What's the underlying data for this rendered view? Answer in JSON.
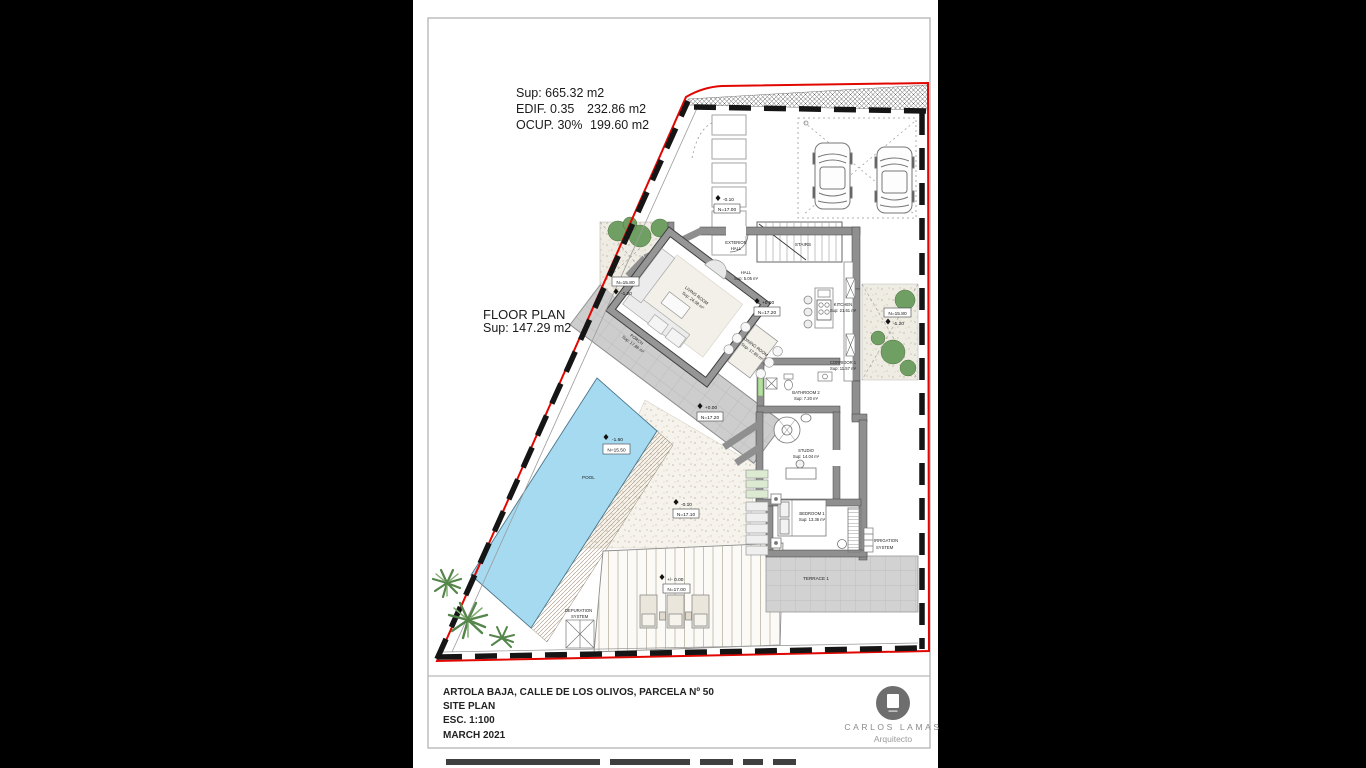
{
  "stats": {
    "line1": "Sup: 665.32 m2",
    "edif_label": "EDIF. 0.35",
    "edif_value": "232.86 m2",
    "ocup_label": "OCUP. 30%",
    "ocup_value": "199.60 m2"
  },
  "floor_plan": {
    "title": "FLOOR PLAN",
    "area": "Sup: 147.29 m2"
  },
  "rooms": {
    "exterior_hall_1": "EXTERIOR",
    "exterior_hall_2": "HALL",
    "hall_name": "HALL",
    "hall_area": "Sup: 5.05 m²",
    "living_name": "LIVING ROOM",
    "living_area": "Sup: 24.58 m²",
    "dining_name": "DINING ROOM",
    "dining_area": "Sup: 17.80 m²",
    "kitchen_name": "KITCHEN",
    "kitchen_area": "Sup: 21.61 m²",
    "corridor_name": "CORRIDOR 1",
    "corridor_area": "Sup: 11.57 m²",
    "bathroom2_name": "BATHROOM 2",
    "bathroom2_area": "Sup: 7.20 m²",
    "studio_name": "STUDIO",
    "studio_area": "Sup: 14.04 m²",
    "bedroom1_name": "BEDROOM 1",
    "bedroom1_area": "Sup: 13.36 m²",
    "terrace_name": "TERRACE 1",
    "porch_name": "PORCH",
    "porch_area": "Sup: 17.86 m²",
    "pool_name": "POOL",
    "stairs_name": "STAIRS"
  },
  "levels": {
    "entrance_delta": "-0.10",
    "entrance_n": "N=17.00",
    "main_delta": "+0.00",
    "main_n": "N=17.20",
    "porch_delta": "+0.00",
    "porch_n": "N=17.20",
    "garden_left_n": "N=15.80",
    "garden_left_delta": "-1.20",
    "garden_right_n": "N=15.80",
    "garden_right_delta": "-1.20",
    "pool_delta": "-1.60",
    "pool_n": "N=15.50",
    "gravel_delta": "-0.10",
    "gravel_n": "N=17.10",
    "deck_delta": "+/- 0.00",
    "deck_n": "N=17.00"
  },
  "systems": {
    "irrigation_1": "IRRIGATION",
    "irrigation_2": "SYSTEM",
    "depuration_1": "DEPURATION",
    "depuration_2": "SYSTEM"
  },
  "title_block": {
    "address": "ARTOLA BAJA, CALLE DE LOS OLIVOS, PARCELA Nº 50",
    "drawing": "SITE PLAN",
    "scale": "ESC. 1:100",
    "date": "MARCH 2021"
  },
  "logo": {
    "name": "CARLOS LAMAS",
    "role": "Arquitecto"
  },
  "colors": {
    "boundary_red": "#e10600",
    "pool_blue": "#a5daf1",
    "wall_gray": "#8f8f8f",
    "plant_green": "#5c8f52",
    "tile_gray": "#cdcdcd"
  }
}
